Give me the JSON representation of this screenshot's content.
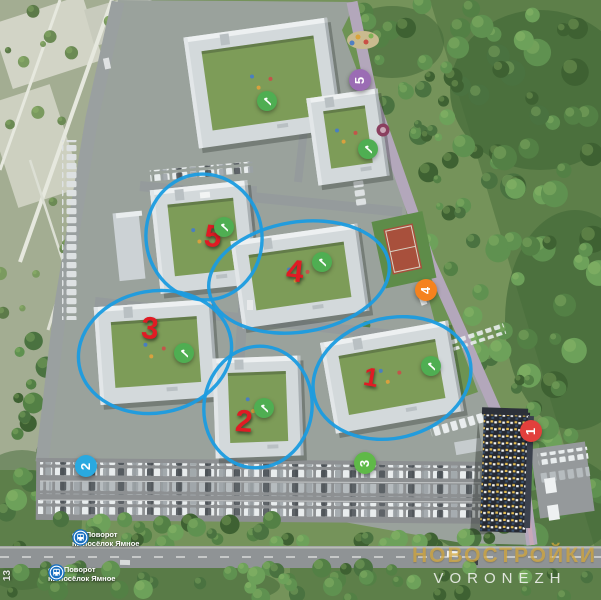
{
  "watermark": {
    "line1": "НОВОСТРОЙКИ",
    "line2": "VORONEZH"
  },
  "page_number": "13",
  "colors": {
    "ellipse_stroke": "#1b9ce0",
    "building_number": "#e01b24",
    "check_bg": "#4fae52",
    "bus_icon_bg": "#176fc1"
  },
  "bus_stops": [
    {
      "line1": "ост.Поворот",
      "line2": "на посёлок Ямное",
      "x": 72,
      "y": 529
    },
    {
      "line1": "ост. Поворот",
      "line2": "на посёлок Ямное",
      "x": 48,
      "y": 564
    }
  ],
  "route_badges": [
    {
      "number": "1",
      "color": "#e2403c",
      "x": 531,
      "y": 431
    },
    {
      "number": "2",
      "color": "#29a9e0",
      "x": 86,
      "y": 466
    },
    {
      "number": "3",
      "color": "#5fb948",
      "x": 365,
      "y": 463
    },
    {
      "number": "4",
      "color": "#f5821f",
      "x": 426,
      "y": 290
    },
    {
      "number": "5",
      "color": "#9b6cb4",
      "x": 360,
      "y": 80
    }
  ],
  "building_numbers": [
    {
      "number": "1",
      "x": 371,
      "y": 377,
      "size": 26,
      "tilt": 10
    },
    {
      "number": "2",
      "x": 244,
      "y": 421,
      "size": 31,
      "tilt": 4
    },
    {
      "number": "3",
      "x": 150,
      "y": 328,
      "size": 31,
      "tilt": 4
    },
    {
      "number": "4",
      "x": 295,
      "y": 271,
      "size": 31,
      "tilt": 6
    },
    {
      "number": "5",
      "x": 213,
      "y": 236,
      "size": 31,
      "tilt": 8
    }
  ],
  "completed_markers": {
    "symbol": "✓",
    "positions": [
      {
        "x": 267,
        "y": 101
      },
      {
        "x": 368,
        "y": 149
      },
      {
        "x": 224,
        "y": 227
      },
      {
        "x": 322,
        "y": 262
      },
      {
        "x": 184,
        "y": 353
      },
      {
        "x": 264,
        "y": 408
      },
      {
        "x": 431,
        "y": 366
      }
    ]
  },
  "highlight_ellipses": [
    {
      "cx": 204,
      "cy": 237,
      "rx": 58,
      "ry": 63,
      "rot": -8
    },
    {
      "cx": 299,
      "cy": 277,
      "rx": 91,
      "ry": 55,
      "rot": -9
    },
    {
      "cx": 155,
      "cy": 352,
      "rx": 77,
      "ry": 61,
      "rot": -10
    },
    {
      "cx": 258,
      "cy": 407,
      "rx": 54,
      "ry": 61,
      "rot": 9
    },
    {
      "cx": 392,
      "cy": 378,
      "rx": 80,
      "ry": 60,
      "rot": -14
    }
  ]
}
